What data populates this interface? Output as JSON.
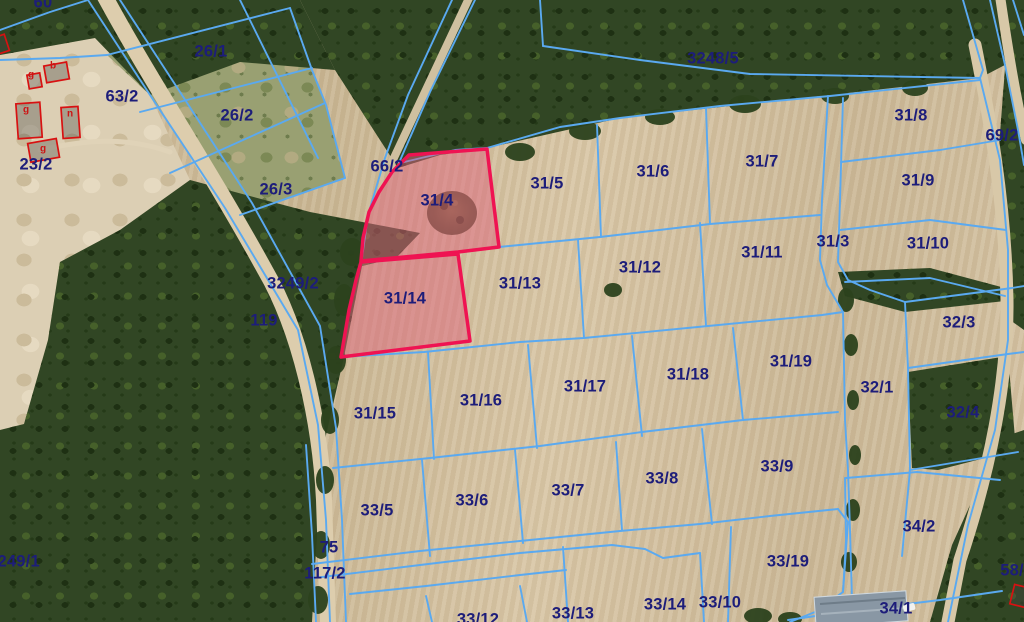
{
  "map": {
    "type": "cadastral-aerial-parcel-map",
    "highlighted_parcels": [
      "31/4",
      "31/14"
    ],
    "colors": {
      "parcel_line": "#5aa9f0",
      "label_text": "#1d1d7a",
      "highlight_stroke": "#ef1352",
      "highlight_fill": "rgba(224,100,125,0.5)",
      "building_outline": "#d81111",
      "building_letter": "#cc1414"
    },
    "parcel_labels": [
      {
        "text": "60",
        "x": 43,
        "y": 3
      },
      {
        "text": "26/1",
        "x": 211,
        "y": 52
      },
      {
        "text": "63/2",
        "x": 122,
        "y": 97
      },
      {
        "text": "26/2",
        "x": 237,
        "y": 116
      },
      {
        "text": "23/2",
        "x": 36,
        "y": 165
      },
      {
        "text": "26/3",
        "x": 276,
        "y": 190
      },
      {
        "text": "3248/5",
        "x": 713,
        "y": 59
      },
      {
        "text": "66/2",
        "x": 387,
        "y": 167
      },
      {
        "text": "31/4",
        "x": 437,
        "y": 201
      },
      {
        "text": "31/5",
        "x": 547,
        "y": 184
      },
      {
        "text": "31/6",
        "x": 653,
        "y": 172
      },
      {
        "text": "31/7",
        "x": 762,
        "y": 162
      },
      {
        "text": "31/8",
        "x": 911,
        "y": 116
      },
      {
        "text": "69/2",
        "x": 1002,
        "y": 136
      },
      {
        "text": "31/9",
        "x": 918,
        "y": 181
      },
      {
        "text": "31/3",
        "x": 833,
        "y": 242
      },
      {
        "text": "31/10",
        "x": 928,
        "y": 244
      },
      {
        "text": "31/11",
        "x": 762,
        "y": 253
      },
      {
        "text": "31/12",
        "x": 640,
        "y": 268
      },
      {
        "text": "3249/2",
        "x": 293,
        "y": 284
      },
      {
        "text": "119",
        "x": 264,
        "y": 321
      },
      {
        "text": "31/13",
        "x": 520,
        "y": 284
      },
      {
        "text": "31/14",
        "x": 405,
        "y": 299
      },
      {
        "text": "31/15",
        "x": 375,
        "y": 414
      },
      {
        "text": "31/16",
        "x": 481,
        "y": 401
      },
      {
        "text": "31/17",
        "x": 585,
        "y": 387
      },
      {
        "text": "31/18",
        "x": 688,
        "y": 375
      },
      {
        "text": "31/19",
        "x": 791,
        "y": 362
      },
      {
        "text": "32/1",
        "x": 877,
        "y": 388
      },
      {
        "text": "32/3",
        "x": 959,
        "y": 323
      },
      {
        "text": "32/4",
        "x": 963,
        "y": 413
      },
      {
        "text": "33/5",
        "x": 377,
        "y": 511
      },
      {
        "text": "33/6",
        "x": 472,
        "y": 501
      },
      {
        "text": "33/7",
        "x": 568,
        "y": 491
      },
      {
        "text": "33/8",
        "x": 662,
        "y": 479
      },
      {
        "text": "33/9",
        "x": 777,
        "y": 467
      },
      {
        "text": "34/2",
        "x": 919,
        "y": 527
      },
      {
        "text": "75",
        "x": 329,
        "y": 548
      },
      {
        "text": "117/2",
        "x": 325,
        "y": 574
      },
      {
        "text": "3249/1",
        "x": 14,
        "y": 562
      },
      {
        "text": "33/19",
        "x": 788,
        "y": 562
      },
      {
        "text": "33/10",
        "x": 720,
        "y": 603
      },
      {
        "text": "33/14",
        "x": 665,
        "y": 605
      },
      {
        "text": "33/13",
        "x": 573,
        "y": 614
      },
      {
        "text": "33/12",
        "x": 478,
        "y": 620
      },
      {
        "text": "34/1",
        "x": 896,
        "y": 609
      },
      {
        "text": "58/",
        "x": 1012,
        "y": 571
      }
    ],
    "building_labels": [
      {
        "text": "g",
        "x": 31,
        "y": 75
      },
      {
        "text": "b",
        "x": 53,
        "y": 66
      },
      {
        "text": "g",
        "x": 26,
        "y": 110
      },
      {
        "text": "n",
        "x": 70,
        "y": 114
      },
      {
        "text": "g",
        "x": 43,
        "y": 149
      }
    ]
  }
}
